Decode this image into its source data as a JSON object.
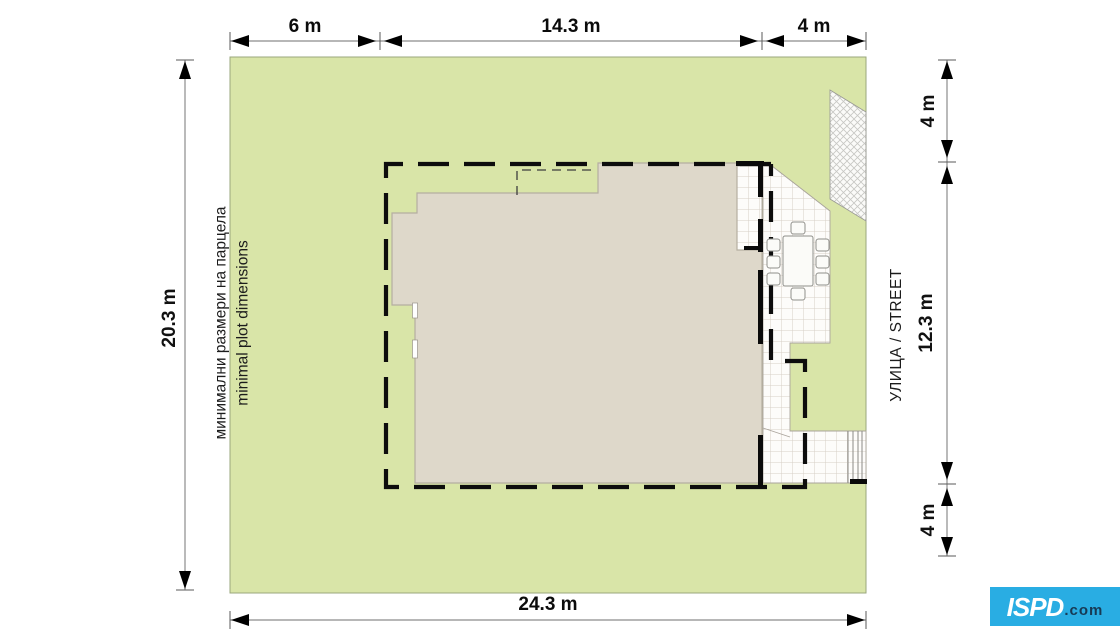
{
  "dimensions": {
    "top": {
      "seg1": "6 m",
      "seg2": "14.3 m",
      "seg3": "4 m"
    },
    "bottom": {
      "total": "24.3 m"
    },
    "left": {
      "total": "20.3 m"
    },
    "right": {
      "seg1": "4 m",
      "seg2": "12.3 m",
      "seg3": "4 m"
    }
  },
  "measurements_m": {
    "plot_width": 24.3,
    "plot_height": 20.3,
    "left_setback": 6,
    "building_zone_width": 14.3,
    "right_setback": 4,
    "street_top_offset": 4,
    "street_middle": 12.3,
    "street_bottom_offset": 4
  },
  "annotations": {
    "plot_caption_bg": "минимални размери на парцела",
    "plot_caption_en": "minimal plot dimensions",
    "street": "УЛИЦА / STREET"
  },
  "logo": {
    "brand": "ISPD",
    "suffix": ".com"
  },
  "colors": {
    "plot_green": "#d9e5a8",
    "house_beige": "#ded8ca",
    "envelope_black": "#0d0d0d",
    "dimension_gray": "#8c8c8c",
    "logo_cyan": "#29ade3",
    "logo_text_dark": "#173a55"
  }
}
